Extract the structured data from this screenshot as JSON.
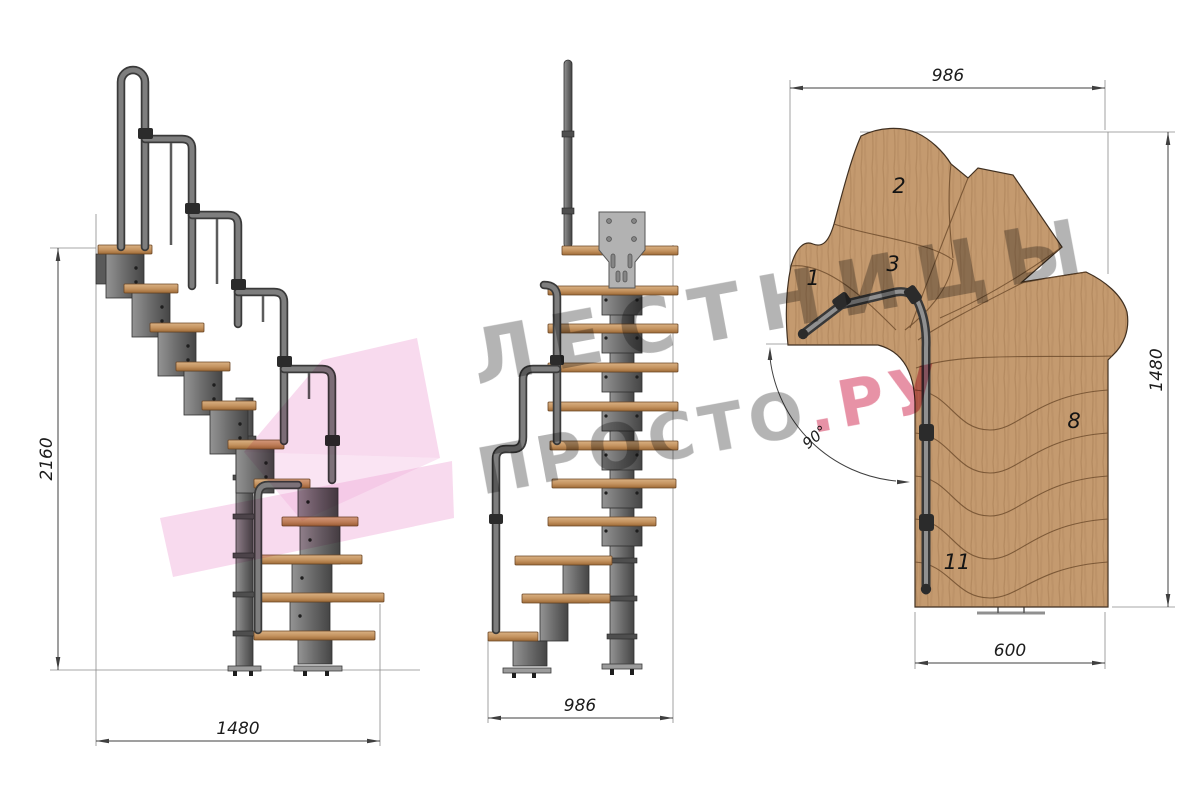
{
  "page": {
    "title": "Чертёж модульной лестницы с поворотом 90°",
    "background": "#ffffff"
  },
  "watermark": {
    "line1": "ЛЕСТНИЦЫ",
    "line2_gray": "ПРОСТО",
    "line2_accent": ".РУ",
    "gray_color": "#909090",
    "accent_color": "#d94f70",
    "logo_color": "#efa6d7"
  },
  "side_view": {
    "dim_height": "2160",
    "dim_width": "1480"
  },
  "front_view": {
    "dim_width": "986"
  },
  "plan_view": {
    "dim_top": "986",
    "dim_right": "1480",
    "dim_bottom": "600",
    "angle": "90°",
    "step_labels": [
      "1",
      "2",
      "3",
      "8",
      "11"
    ]
  },
  "colors": {
    "wood": "#c49a6f",
    "wood_outline": "#3f2f20",
    "metal": "#6f6f6f",
    "dimension_line": "#3f3f3f"
  }
}
